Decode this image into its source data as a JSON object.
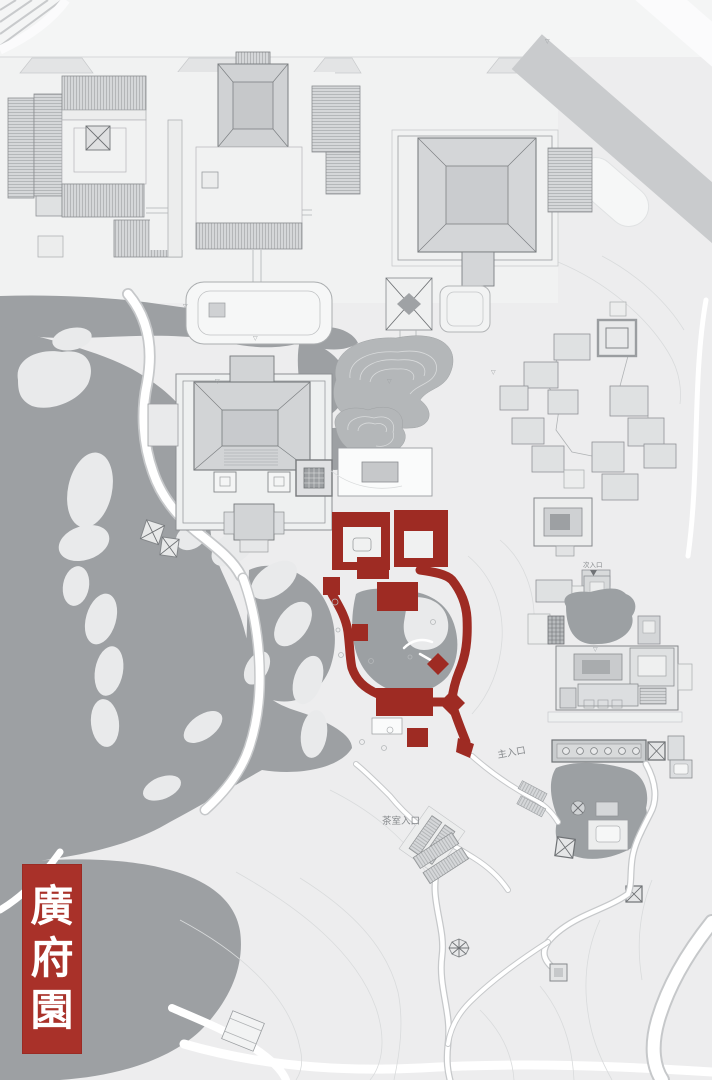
{
  "page": {
    "width": 712,
    "height": 1080,
    "kind": "garden-master-plan"
  },
  "title": {
    "text": "廣府園",
    "chars": [
      "廣",
      "府",
      "園"
    ]
  },
  "labels": {
    "main_entrance": "主入口",
    "tea_room_entrance": "茶室入口",
    "secondary_entrance": "次入口"
  },
  "symbols": {
    "elevation_marker": "▽"
  },
  "colors": {
    "background": "#ededee",
    "plaza": "#f1f2f2",
    "water": "#9da0a3",
    "rockery": "#b4b7b9",
    "building": "#dfe1e2",
    "roof": "#d4d6d8",
    "outline": "#8b8e91",
    "road": "#c9cbcd",
    "highlight_red": "#9e2b23",
    "badge_red": "#a93129",
    "badge_text": "#ffffff"
  }
}
